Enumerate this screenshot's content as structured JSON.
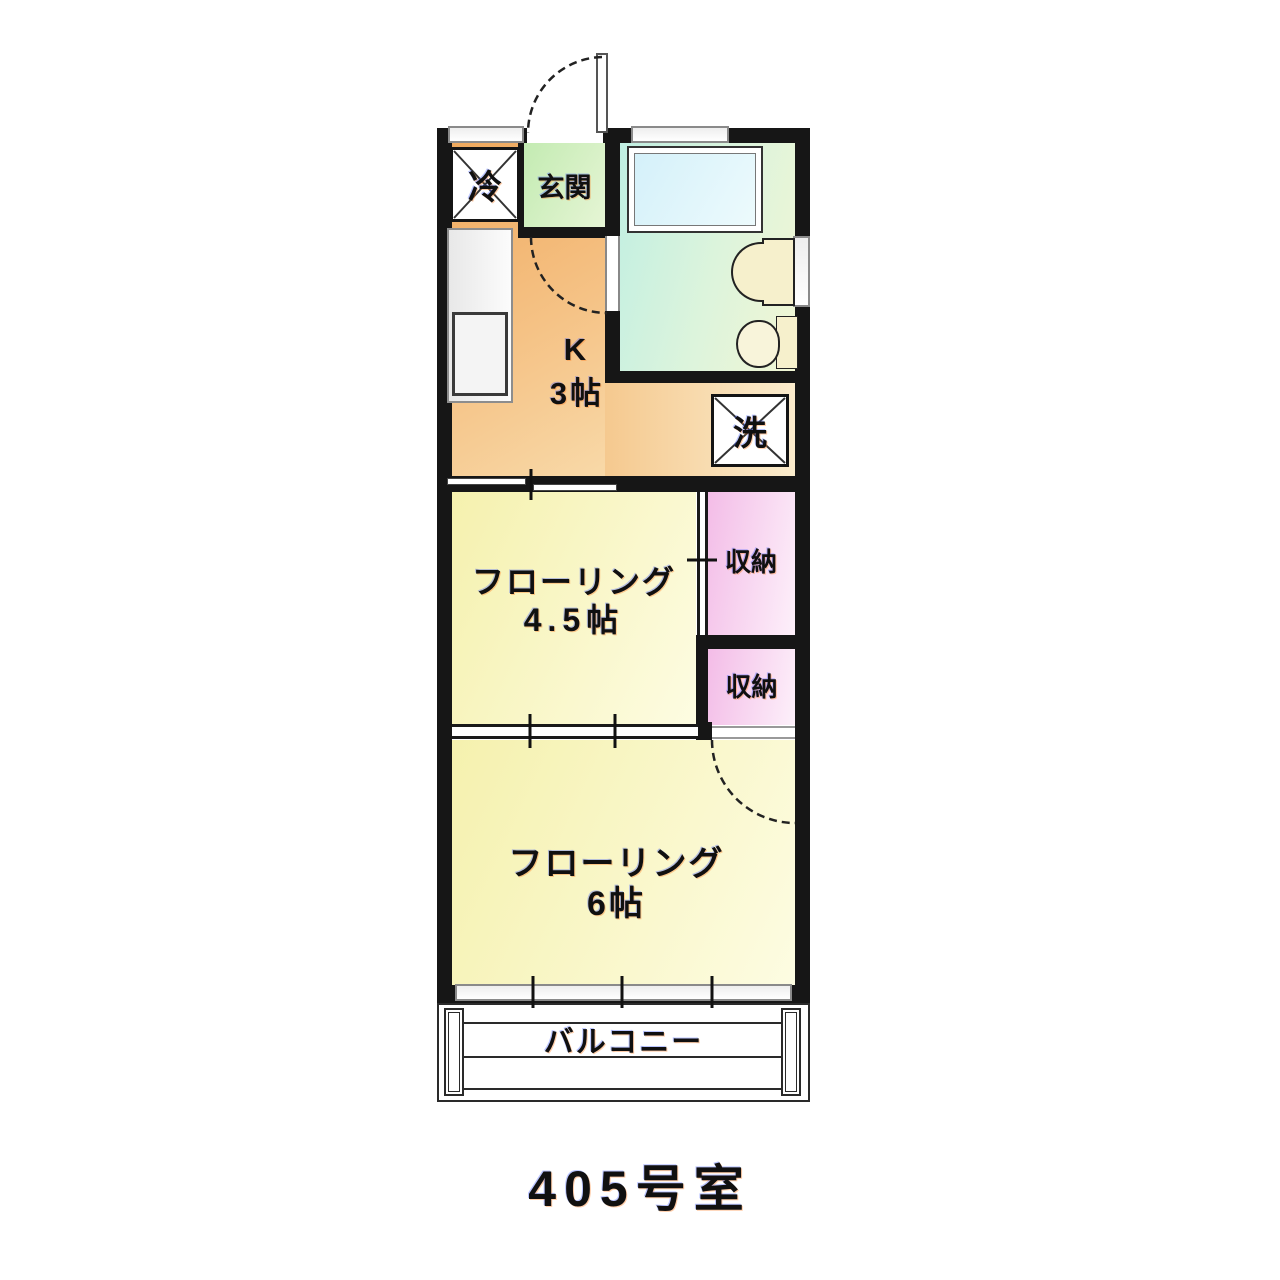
{
  "unit_title": "405号室",
  "labels": {
    "refrigerator": "冷",
    "entrance": "玄関",
    "kitchen_line1": "K",
    "kitchen_line2": "3帖",
    "washer": "洗",
    "room45_line1": "フローリング",
    "room45_line2": "4.5帖",
    "storage_upper": "収納",
    "storage_lower": "収納",
    "room6_line1": "フローリング",
    "room6_line2": "6帖",
    "balcony": "バルコニー"
  },
  "colors": {
    "wall": "#161616",
    "kitchen": "#f5c285",
    "entrance": "#c3ebb2",
    "bathroom": "#c0efe2",
    "bathtub": "#d3f0f9",
    "flooring": "#f5f1ae",
    "storage": "#f3bce7",
    "fixture_cream": "#f6f0cc",
    "background": "#ffffff"
  }
}
